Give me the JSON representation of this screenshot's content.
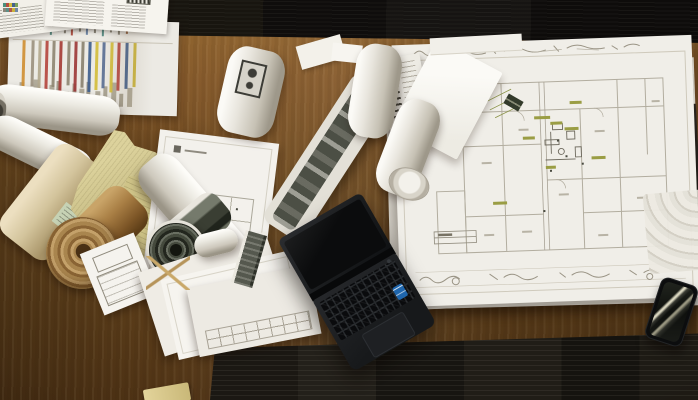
{
  "scene": {
    "description": "Top-down photograph of a wooden desk covered with architectural blueprints, rolled-up plans, loose papers, a black laptop and a smartphone, with dark carpet visible at the top and bottom edges",
    "objects": {
      "desk": "Wooden desk surface",
      "carpet": "Dark carpet floor",
      "blueprint": "Large architectural floor-plan blueprint",
      "envelope": "White envelope lying on the blueprint",
      "chart_sheet": "Survey sheet with colored vertical stripes",
      "papers": "Stacks of loose white papers and forms",
      "rolls": "Rolled-up drawing tubes",
      "kraft_roll": "Rolled kraft paper",
      "dark_roll": "Rolled drawing with dark printed side",
      "plan_sheet": "Sheet with small floor-plan drawing",
      "form_sheet": "Form sheet with outlined boxes",
      "laptop": "Black laptop with keyboard, touchpad and Intel sticker",
      "phone": "Smartphone with bright screen reflections",
      "yellowed_paper": "Old yellowed papers"
    }
  },
  "palette": {
    "wood_light": "#94682f",
    "wood_mid": "#6f4b20",
    "wood_dark": "#4f3315",
    "carpet": "#141210",
    "paper_white": "#f0eee8",
    "paper_shadow": "#b5afa2",
    "kraft": "#a87e44",
    "old_paper": "#cfc488",
    "blueprint_line": "#b2ad9f",
    "highlight_olive": "#9a9d44",
    "laptop_body": "#1b1d1f",
    "intel_blue": "#1f66ad",
    "phone_black": "#0c0d0e"
  },
  "chart_sheet": {
    "accent_stripes": [
      {
        "x": 14,
        "w": 3,
        "h": 50,
        "c": "#cf8f35"
      },
      {
        "x": 23,
        "w": 3,
        "h": 46,
        "c": "#9c9180"
      },
      {
        "x": 30,
        "w": 3,
        "h": 48,
        "c": "#b3a88e"
      },
      {
        "x": 37,
        "w": 3,
        "h": 52,
        "c": "#b5463f"
      },
      {
        "x": 44,
        "w": 3,
        "h": 46,
        "c": "#8f8773"
      },
      {
        "x": 51,
        "w": 3,
        "h": 50,
        "c": "#a63d37"
      },
      {
        "x": 59,
        "w": 3,
        "h": 44,
        "c": "#8f8773"
      },
      {
        "x": 66,
        "w": 3,
        "h": 50,
        "c": "#9d3a3a"
      },
      {
        "x": 73,
        "w": 3,
        "h": 46,
        "c": "#8a8270"
      },
      {
        "x": 80,
        "w": 3,
        "h": 50,
        "c": "#3f5f8e"
      },
      {
        "x": 87,
        "w": 3,
        "h": 48,
        "c": "#d3bd3c"
      },
      {
        "x": 94,
        "w": 3,
        "h": 46,
        "c": "#5a6f94"
      },
      {
        "x": 102,
        "w": 3,
        "h": 50,
        "c": "#d3bd3c"
      },
      {
        "x": 109,
        "w": 3,
        "h": 48,
        "c": "#b5463f"
      },
      {
        "x": 117,
        "w": 3,
        "h": 46,
        "c": "#44618c"
      },
      {
        "x": 125,
        "w": 3,
        "h": 44,
        "c": "#c9b23a"
      }
    ],
    "grey_bars": [
      {
        "x": 12,
        "w": 5,
        "h": 22,
        "c": "#b1ab9a"
      },
      {
        "x": 19,
        "w": 4,
        "h": 15,
        "c": "#a8a292"
      },
      {
        "x": 26,
        "w": 6,
        "h": 25,
        "c": "#b1ab9a"
      },
      {
        "x": 35,
        "w": 4,
        "h": 12,
        "c": "#aba595"
      },
      {
        "x": 42,
        "w": 5,
        "h": 20,
        "c": "#b1ab9a"
      },
      {
        "x": 49,
        "w": 4,
        "h": 24,
        "c": "#a39d8d"
      },
      {
        "x": 57,
        "w": 5,
        "h": 14,
        "c": "#b1ab9a"
      },
      {
        "x": 65,
        "w": 4,
        "h": 22,
        "c": "#aaa494"
      },
      {
        "x": 72,
        "w": 5,
        "h": 17,
        "c": "#b1ab9a"
      },
      {
        "x": 79,
        "w": 4,
        "h": 24,
        "c": "#a39d8d"
      },
      {
        "x": 88,
        "w": 5,
        "h": 15,
        "c": "#b1ab9a"
      },
      {
        "x": 96,
        "w": 4,
        "h": 20,
        "c": "#aba595"
      },
      {
        "x": 104,
        "w": 5,
        "h": 24,
        "c": "#b1ab9a"
      },
      {
        "x": 112,
        "w": 4,
        "h": 13,
        "c": "#a8a292"
      },
      {
        "x": 120,
        "w": 5,
        "h": 19,
        "c": "#b1ab9a"
      }
    ],
    "doodles": [
      {
        "x": 8,
        "w": 2,
        "h": 6,
        "c": "#8a8578"
      },
      {
        "x": 14,
        "w": 2,
        "h": 9,
        "c": "#6f87a6"
      },
      {
        "x": 20,
        "w": 2,
        "h": 5,
        "c": "#8a8578"
      },
      {
        "x": 27,
        "w": 2,
        "h": 8,
        "c": "#b05548"
      },
      {
        "x": 34,
        "w": 2,
        "h": 6,
        "c": "#8a8578"
      },
      {
        "x": 41,
        "w": 2,
        "h": 9,
        "c": "#5d8f86"
      },
      {
        "x": 48,
        "w": 2,
        "h": 5,
        "c": "#8a8578"
      },
      {
        "x": 55,
        "w": 2,
        "h": 7,
        "c": "#8a8578"
      },
      {
        "x": 62,
        "w": 2,
        "h": 9,
        "c": "#b05548"
      },
      {
        "x": 70,
        "w": 2,
        "h": 5,
        "c": "#8a8578"
      },
      {
        "x": 77,
        "w": 2,
        "h": 8,
        "c": "#6f87a6"
      },
      {
        "x": 85,
        "w": 2,
        "h": 6,
        "c": "#8a8578"
      },
      {
        "x": 93,
        "w": 2,
        "h": 9,
        "c": "#5d8f86"
      },
      {
        "x": 101,
        "w": 2,
        "h": 5,
        "c": "#8a8578"
      },
      {
        "x": 109,
        "w": 2,
        "h": 7,
        "c": "#8a8578"
      },
      {
        "x": 117,
        "w": 2,
        "h": 6,
        "c": "#9a6a4a"
      }
    ]
  },
  "sticker_pixels": [
    {
      "x": 1,
      "y": 1,
      "w": 3,
      "h": 4,
      "c": "#4a8f7a"
    },
    {
      "x": 4,
      "y": 1,
      "w": 3,
      "h": 4,
      "c": "#b54d3f"
    },
    {
      "x": 7,
      "y": 1,
      "w": 3,
      "h": 4,
      "c": "#d3bd3c"
    },
    {
      "x": 10,
      "y": 1,
      "w": 3,
      "h": 4,
      "c": "#44618c"
    },
    {
      "x": 13,
      "y": 1,
      "w": 3,
      "h": 4,
      "c": "#7aa05a"
    },
    {
      "x": 1,
      "y": 6,
      "w": 3,
      "h": 4,
      "c": "#8a8578"
    },
    {
      "x": 4,
      "y": 6,
      "w": 3,
      "h": 4,
      "c": "#5d8f86"
    },
    {
      "x": 7,
      "y": 6,
      "w": 3,
      "h": 4,
      "c": "#b05548"
    },
    {
      "x": 10,
      "y": 6,
      "w": 3,
      "h": 4,
      "c": "#c9b23a"
    },
    {
      "x": 13,
      "y": 6,
      "w": 3,
      "h": 4,
      "c": "#6f87a6"
    }
  ]
}
